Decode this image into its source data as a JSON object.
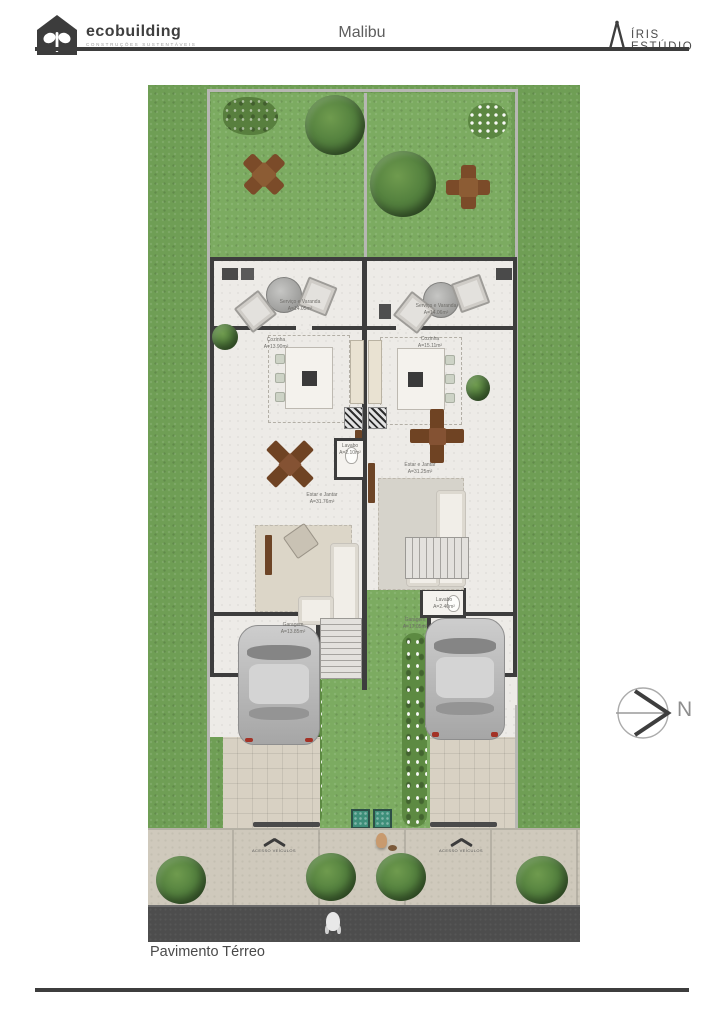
{
  "header": {
    "brand_name": "ecobuilding",
    "brand_tagline": "CONSTRUÇÕES SUSTENTÁVEIS",
    "project_title": "Malibu",
    "studio_name": "ÍRIS ESTÚDIO"
  },
  "floorplan": {
    "caption": "Pavimento Térreo",
    "compass_label": "N",
    "access_ramp_label": "ACESSO VEÍCULOS",
    "units": {
      "left": {
        "varanda": {
          "name": "Serviço e Varanda",
          "area": "A=14.05m²"
        },
        "cozinha": {
          "name": "Cozinha",
          "area": "A=13.90m²"
        },
        "lavabo": {
          "name": "Lavabo",
          "area": "A=2.10m²"
        },
        "estar": {
          "name": "Estar e Jantar",
          "area": "A=31.76m²"
        },
        "garagem": {
          "name": "Garagem",
          "area": "A=13.85m²"
        }
      },
      "right": {
        "varanda": {
          "name": "Serviço e Varanda",
          "area": "A=14.06m²"
        },
        "cozinha": {
          "name": "Cozinha",
          "area": "A=15.11m²"
        },
        "lavabo": {
          "name": "Lavabo",
          "area": "A=2.40m²"
        },
        "estar": {
          "name": "Estar e Jantar",
          "area": "A=31.25m²"
        },
        "garagem": {
          "name": "Garagem",
          "area": "A=17.05m²"
        }
      }
    },
    "colors": {
      "lawn_outer": "#6f9e55",
      "lawn_inner": "#7cab61",
      "wall": "#3d3d3d",
      "floor": "#edebe7",
      "driveway": "#d8d1c3",
      "sidewalk": "#cfc9bc",
      "street": "#4d4d4d",
      "rule": "#3d3d3d"
    }
  }
}
